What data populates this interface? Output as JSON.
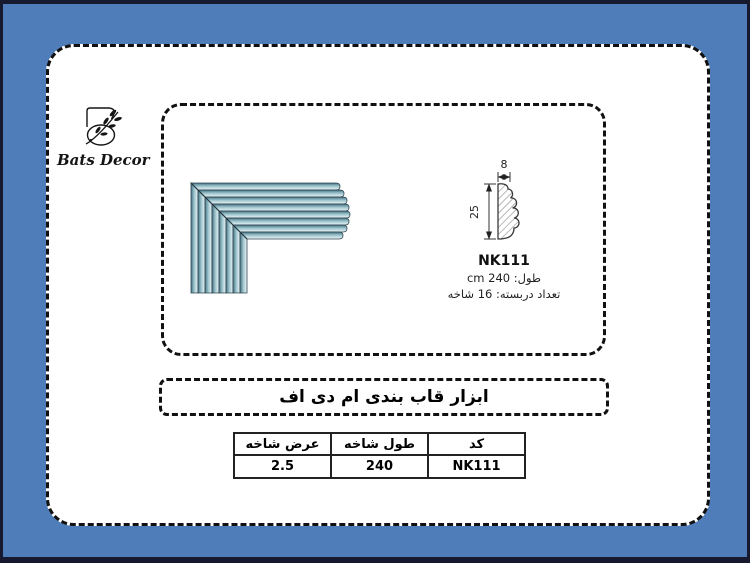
{
  "colors": {
    "page_blue": "#4f7db9",
    "frame_dark": "#171a2e",
    "molding_dark": "#44707f",
    "molding_light": "#eff7f8"
  },
  "brand": {
    "name": "Bats Decor"
  },
  "panel": {
    "profile": {
      "code": "NK111",
      "width_dim": "8",
      "height_dim": "25",
      "length_label": "طول: 240 cm",
      "pack_label": "تعداد دربسته: 16 شاخه"
    }
  },
  "title_band": {
    "title": "ابزار قاب بندی ام دی اف"
  },
  "table": {
    "headers": [
      "عرض شاخه",
      "طول شاخه",
      "کد"
    ],
    "rows": [
      [
        "2.5",
        "240",
        "NK111"
      ]
    ]
  }
}
